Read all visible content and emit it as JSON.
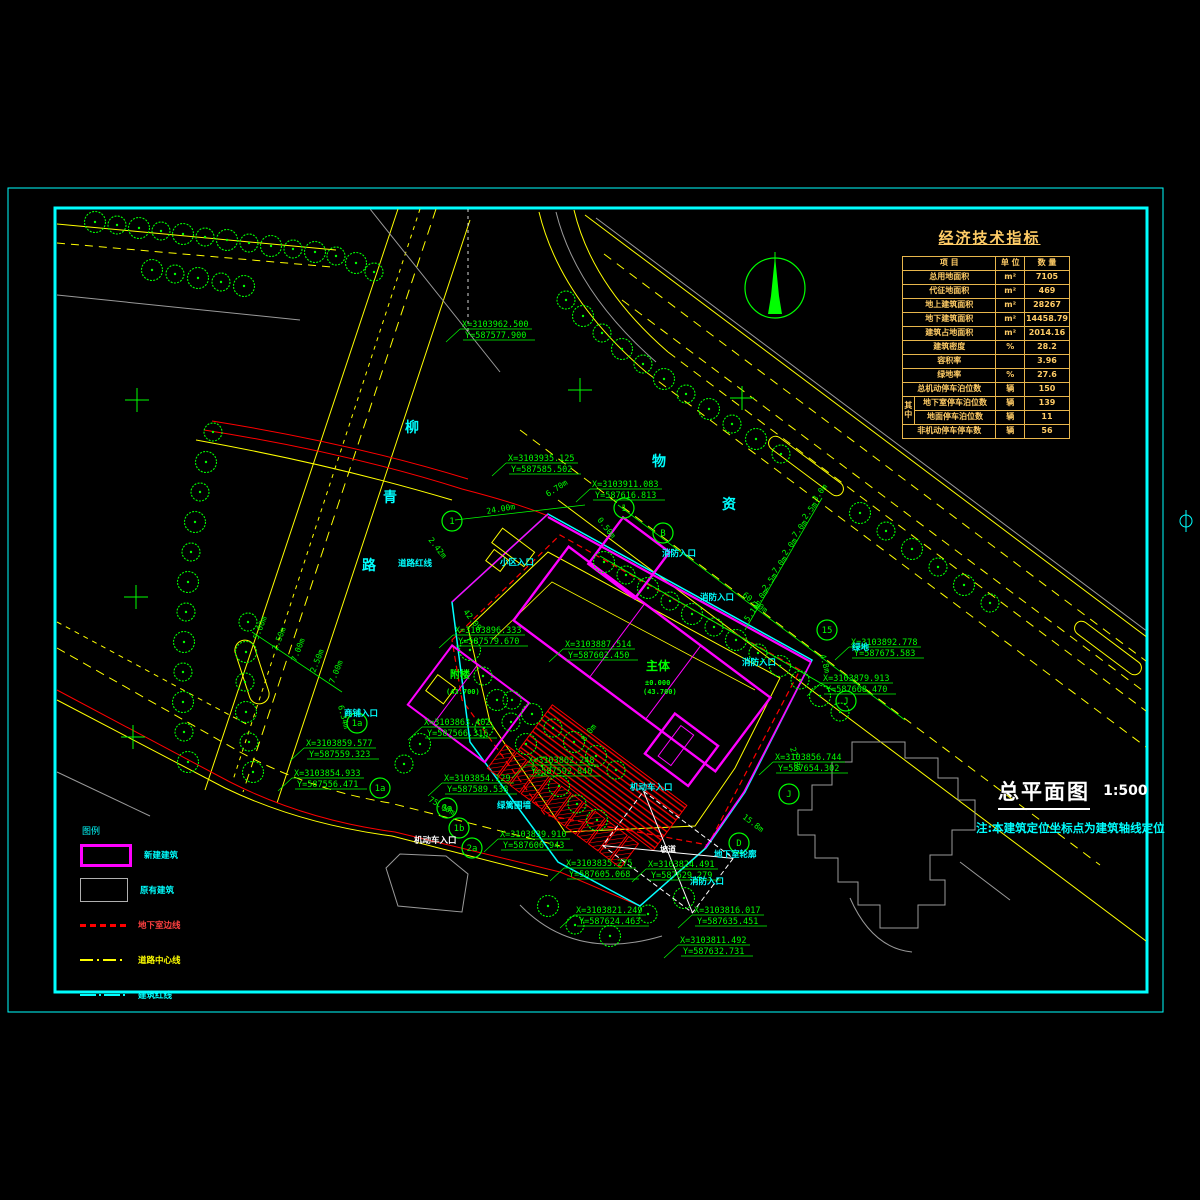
{
  "colors": {
    "cad_yellow": "#ffff00",
    "cad_green": "#00ff00",
    "cad_cyan": "#00ffff",
    "cad_magenta": "#ff00ff",
    "cad_red": "#ff0000",
    "cad_gray": "#9a9a9a",
    "table_orange": "#ffcc66",
    "frame_cyan": "#00ffff"
  },
  "title_block": {
    "title": "总平面图",
    "scale": "1:500",
    "note": "注:本建筑定位坐标点为建筑轴线定位"
  },
  "econ_table": {
    "title": "经济技术指标",
    "headers": [
      "项      目",
      "单 位",
      "数 量"
    ],
    "group_label": "其中",
    "rows": [
      {
        "item": "总用地面积",
        "unit": "m²",
        "value": "7105"
      },
      {
        "item": "代征地面积",
        "unit": "m²",
        "value": "469"
      },
      {
        "item": "地上建筑面积",
        "unit": "m²",
        "value": "28267"
      },
      {
        "item": "地下建筑面积",
        "unit": "m²",
        "value": "14458.79"
      },
      {
        "item": "建筑占地面积",
        "unit": "m²",
        "value": "2014.16"
      },
      {
        "item": "建筑密度",
        "unit": "%",
        "value": "28.2"
      },
      {
        "item": "容积率",
        "unit": "",
        "value": "3.96"
      },
      {
        "item": "绿地率",
        "unit": "%",
        "value": "27.6"
      },
      {
        "item": "总机动停车泊位数",
        "unit": "辆",
        "value": "150"
      },
      {
        "item": "地下室停车泊位数",
        "unit": "辆",
        "value": "139",
        "group": "start"
      },
      {
        "item": "地面停车泊位数",
        "unit": "辆",
        "value": "11",
        "group": "cont"
      },
      {
        "item": "非机动停车停车数",
        "unit": "辆",
        "value": "56"
      }
    ]
  },
  "legend": {
    "title": "图例",
    "items": [
      {
        "label": "新建建筑",
        "swatch": "new-building",
        "label_color": "#00ffff"
      },
      {
        "label": "原有建筑",
        "swatch": "existing-building",
        "label_color": "#00ffff"
      },
      {
        "label": "地下室边线",
        "swatch": "underground-line",
        "label_color": "#ff4040"
      },
      {
        "label": "道路中心线",
        "swatch": "road-centerline",
        "label_color": "#ffff00"
      },
      {
        "label": "建筑红线",
        "swatch": "boundary-line",
        "label_color": "#00ffff"
      }
    ]
  },
  "plan": {
    "street_chars": [
      {
        "ch": "柳",
        "x": 405,
        "y": 432
      },
      {
        "ch": "青",
        "x": 383,
        "y": 502
      },
      {
        "ch": "路",
        "x": 362,
        "y": 570
      },
      {
        "ch": "物",
        "x": 652,
        "y": 466
      },
      {
        "ch": "资",
        "x": 722,
        "y": 509
      }
    ],
    "coordinates": [
      {
        "x": 462,
        "y": 327,
        "l1": "X=3103962.500",
        "l2": "Y=587577.900"
      },
      {
        "x": 508,
        "y": 461,
        "l1": "X=3103935.125",
        "l2": "Y=587585.502"
      },
      {
        "x": 592,
        "y": 487,
        "l1": "X=3103911.083",
        "l2": "Y=587616.813"
      },
      {
        "x": 455,
        "y": 633,
        "l1": "X=3103896.333",
        "l2": "Y=587579.670"
      },
      {
        "x": 565,
        "y": 647,
        "l1": "X=3103887.514",
        "l2": "Y=587602.450"
      },
      {
        "x": 851,
        "y": 645,
        "l1": "X=3103892.778",
        "l2": "Y=587675.583"
      },
      {
        "x": 823,
        "y": 681,
        "l1": "X=3103879.913",
        "l2": "Y=587668.470"
      },
      {
        "x": 424,
        "y": 725,
        "l1": "X=3103863.402",
        "l2": "Y=587566.316"
      },
      {
        "x": 306,
        "y": 746,
        "l1": "X=3103859.577",
        "l2": "Y=587559.323"
      },
      {
        "x": 294,
        "y": 776,
        "l1": "X=3103854.933",
        "l2": "Y=587556.471"
      },
      {
        "x": 444,
        "y": 781,
        "l1": "X=3103854.129",
        "l2": "Y=587589.538"
      },
      {
        "x": 775,
        "y": 760,
        "l1": "X=3103856.744",
        "l2": "Y=587654.302"
      },
      {
        "x": 528,
        "y": 763,
        "l1": "X=3103862.248",
        "l2": "Y=587592.840"
      },
      {
        "x": 500,
        "y": 837,
        "l1": "X=3103839.910",
        "l2": "Y=587606.943"
      },
      {
        "x": 566,
        "y": 866,
        "l1": "X=3103835.275",
        "l2": "Y=587605.068"
      },
      {
        "x": 648,
        "y": 867,
        "l1": "X=3103824.491",
        "l2": "Y=587629.279"
      },
      {
        "x": 576,
        "y": 913,
        "l1": "X=3103821.249",
        "l2": "Y=587624.463"
      },
      {
        "x": 694,
        "y": 913,
        "l1": "X=3103816.017",
        "l2": "Y=587635.451"
      },
      {
        "x": 680,
        "y": 943,
        "l1": "X=3103811.492",
        "l2": "Y=587632.731"
      }
    ],
    "dimensions": [
      {
        "t": "24.00m",
        "x": 487,
        "y": 514,
        "r": -10
      },
      {
        "t": "6.70m",
        "x": 548,
        "y": 497,
        "r": -33
      },
      {
        "t": "2.42m",
        "x": 428,
        "y": 540,
        "r": 52
      },
      {
        "t": "0.50m",
        "x": 597,
        "y": 520,
        "r": 52
      },
      {
        "t": "60.50m",
        "x": 742,
        "y": 596,
        "r": 37
      },
      {
        "t": "5.1m",
        "x": 748,
        "y": 622,
        "r": -53
      },
      {
        "t": "1.0m",
        "x": 757,
        "y": 607,
        "r": -53
      },
      {
        "t": "2.5m",
        "x": 766,
        "y": 591,
        "r": -53
      },
      {
        "t": "7.0m",
        "x": 776,
        "y": 574,
        "r": -53
      },
      {
        "t": "2.0m",
        "x": 786,
        "y": 556,
        "r": -53
      },
      {
        "t": "7.0m",
        "x": 796,
        "y": 538,
        "r": -53
      },
      {
        "t": "2.5m",
        "x": 806,
        "y": 520,
        "r": -53
      },
      {
        "t": "3.0m",
        "x": 816,
        "y": 502,
        "r": -53
      },
      {
        "t": "75.00m",
        "x": 428,
        "y": 801,
        "r": 30
      },
      {
        "t": "27.8m",
        "x": 790,
        "y": 748,
        "r": 75
      },
      {
        "t": "4.8m",
        "x": 820,
        "y": 655,
        "r": 75
      },
      {
        "t": "15.8m",
        "x": 742,
        "y": 818,
        "r": 37
      },
      {
        "t": "42.09",
        "x": 463,
        "y": 612,
        "r": 52
      },
      {
        "t": "8.0m",
        "x": 585,
        "y": 742,
        "r": -53
      },
      {
        "t": "6.34m",
        "x": 338,
        "y": 706,
        "r": 75
      },
      {
        "t": "5.00m",
        "x": 258,
        "y": 640,
        "r": -68
      },
      {
        "t": "2.50m",
        "x": 277,
        "y": 651,
        "r": -68
      },
      {
        "t": "7.00m",
        "x": 296,
        "y": 662,
        "r": -68
      },
      {
        "t": "2.50m",
        "x": 315,
        "y": 673,
        "r": -68
      },
      {
        "t": "7.00m",
        "x": 334,
        "y": 684,
        "r": -68
      }
    ],
    "bubbles": [
      {
        "l": "1",
        "x": 452,
        "y": 521
      },
      {
        "l": "1",
        "x": 624,
        "y": 508
      },
      {
        "l": "B",
        "x": 663,
        "y": 533
      },
      {
        "l": "15",
        "x": 827,
        "y": 630
      },
      {
        "l": "J",
        "x": 846,
        "y": 701
      },
      {
        "l": "J",
        "x": 789,
        "y": 794
      },
      {
        "l": "D",
        "x": 739,
        "y": 843
      },
      {
        "l": "1a",
        "x": 357,
        "y": 723
      },
      {
        "l": "1a",
        "x": 380,
        "y": 788
      },
      {
        "l": "3a",
        "x": 447,
        "y": 808
      },
      {
        "l": "1b",
        "x": 459,
        "y": 828
      },
      {
        "l": "2a",
        "x": 472,
        "y": 848
      }
    ],
    "labels": [
      {
        "t": "小区入口",
        "x": 500,
        "y": 565
      },
      {
        "t": "消防入口",
        "x": 662,
        "y": 556
      },
      {
        "t": "消防入口",
        "x": 700,
        "y": 600
      },
      {
        "t": "消防入口",
        "x": 742,
        "y": 665
      },
      {
        "t": "消防入口",
        "x": 690,
        "y": 884
      },
      {
        "t": "机动车入口",
        "x": 630,
        "y": 790
      },
      {
        "t": "机动车入口",
        "x": 414,
        "y": 843,
        "c": "#ffffff"
      },
      {
        "t": "商铺入口",
        "x": 344,
        "y": 716
      },
      {
        "t": "地下室轮廓",
        "x": 714,
        "y": 857
      },
      {
        "t": "道路红线",
        "x": 398,
        "y": 566
      },
      {
        "t": "绿篱围墙",
        "x": 497,
        "y": 808
      },
      {
        "t": "绿地",
        "x": 852,
        "y": 650
      },
      {
        "t": "坡道",
        "x": 660,
        "y": 852,
        "c": "#ffffff",
        "s": 8
      },
      {
        "t": "主体",
        "x": 646,
        "y": 670,
        "c": "#00ff00",
        "s": 12
      },
      {
        "t": "±0.000",
        "x": 645,
        "y": 685,
        "c": "#00ff00",
        "s": 7
      },
      {
        "t": "(43.700)",
        "x": 643,
        "y": 694,
        "c": "#00ff00",
        "s": 7
      },
      {
        "t": "附楼",
        "x": 450,
        "y": 678,
        "c": "#00ff00",
        "s": 10
      },
      {
        "t": "(43.700)",
        "x": 446,
        "y": 694,
        "c": "#00ff00",
        "s": 7
      }
    ]
  }
}
